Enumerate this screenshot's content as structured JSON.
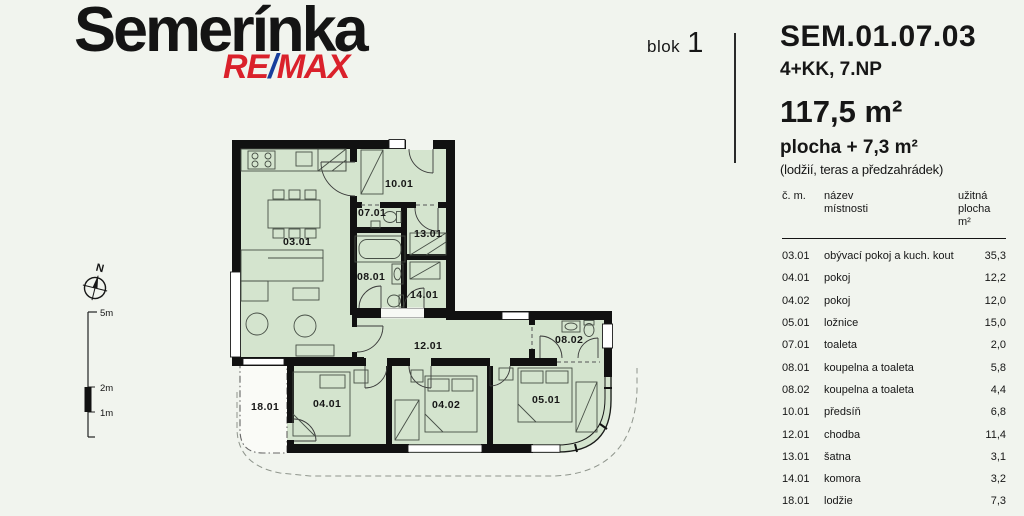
{
  "header": {
    "project_title": "Semerínka",
    "logo": {
      "re": "RE",
      "slash": "/",
      "max": "MAX"
    },
    "block_word": "blok",
    "block_number": "1",
    "unit_code": "SEM.01.07.03",
    "unit_layout": "4+KK, 7.NP",
    "unit_area": "117,5 m²",
    "extra_area": "plocha + 7,3 m²",
    "extra_area_note": "(lodžií, teras a předzahrádek)"
  },
  "compass": {
    "north_label": "N"
  },
  "scale_bar": {
    "m5": "5m",
    "m2": "2m",
    "m1": "1m"
  },
  "floor_plan": {
    "labels": {
      "living": "03.01",
      "hall": "10.01",
      "wc": "07.01",
      "closet": "13.01",
      "bath": "08.01",
      "storage": "14.01",
      "corridor": "12.01",
      "bath2": "08.02",
      "bed1": "04.01",
      "bed2": "04.02",
      "bed3": "05.01",
      "loggia": "18.01"
    }
  },
  "table": {
    "col_room_no": "č. m.",
    "col_room_name_1": "název",
    "col_room_name_2": "místnosti",
    "col_area_1": "užitná",
    "col_area_2": "plocha m²",
    "rows": [
      {
        "no": "03.01",
        "name": "obývací pokoj a kuch. kout",
        "area": "35,3"
      },
      {
        "no": "04.01",
        "name": "pokoj",
        "area": "12,2"
      },
      {
        "no": "04.02",
        "name": "pokoj",
        "area": "12,0"
      },
      {
        "no": "05.01",
        "name": "ložnice",
        "area": "15,0"
      },
      {
        "no": "07.01",
        "name": "toaleta",
        "area": "2,0"
      },
      {
        "no": "08.01",
        "name": "koupelna a toaleta",
        "area": "5,8"
      },
      {
        "no": "08.02",
        "name": "koupelna a toaleta",
        "area": "4,4"
      },
      {
        "no": "10.01",
        "name": "předsíň",
        "area": "6,8"
      },
      {
        "no": "12.01",
        "name": "chodba",
        "area": "11,4"
      },
      {
        "no": "13.01",
        "name": "šatna",
        "area": "3,1"
      },
      {
        "no": "14.01",
        "name": "komora",
        "area": "3,2"
      },
      {
        "no": "18.01",
        "name": "lodžie",
        "area": "7,3"
      }
    ]
  }
}
